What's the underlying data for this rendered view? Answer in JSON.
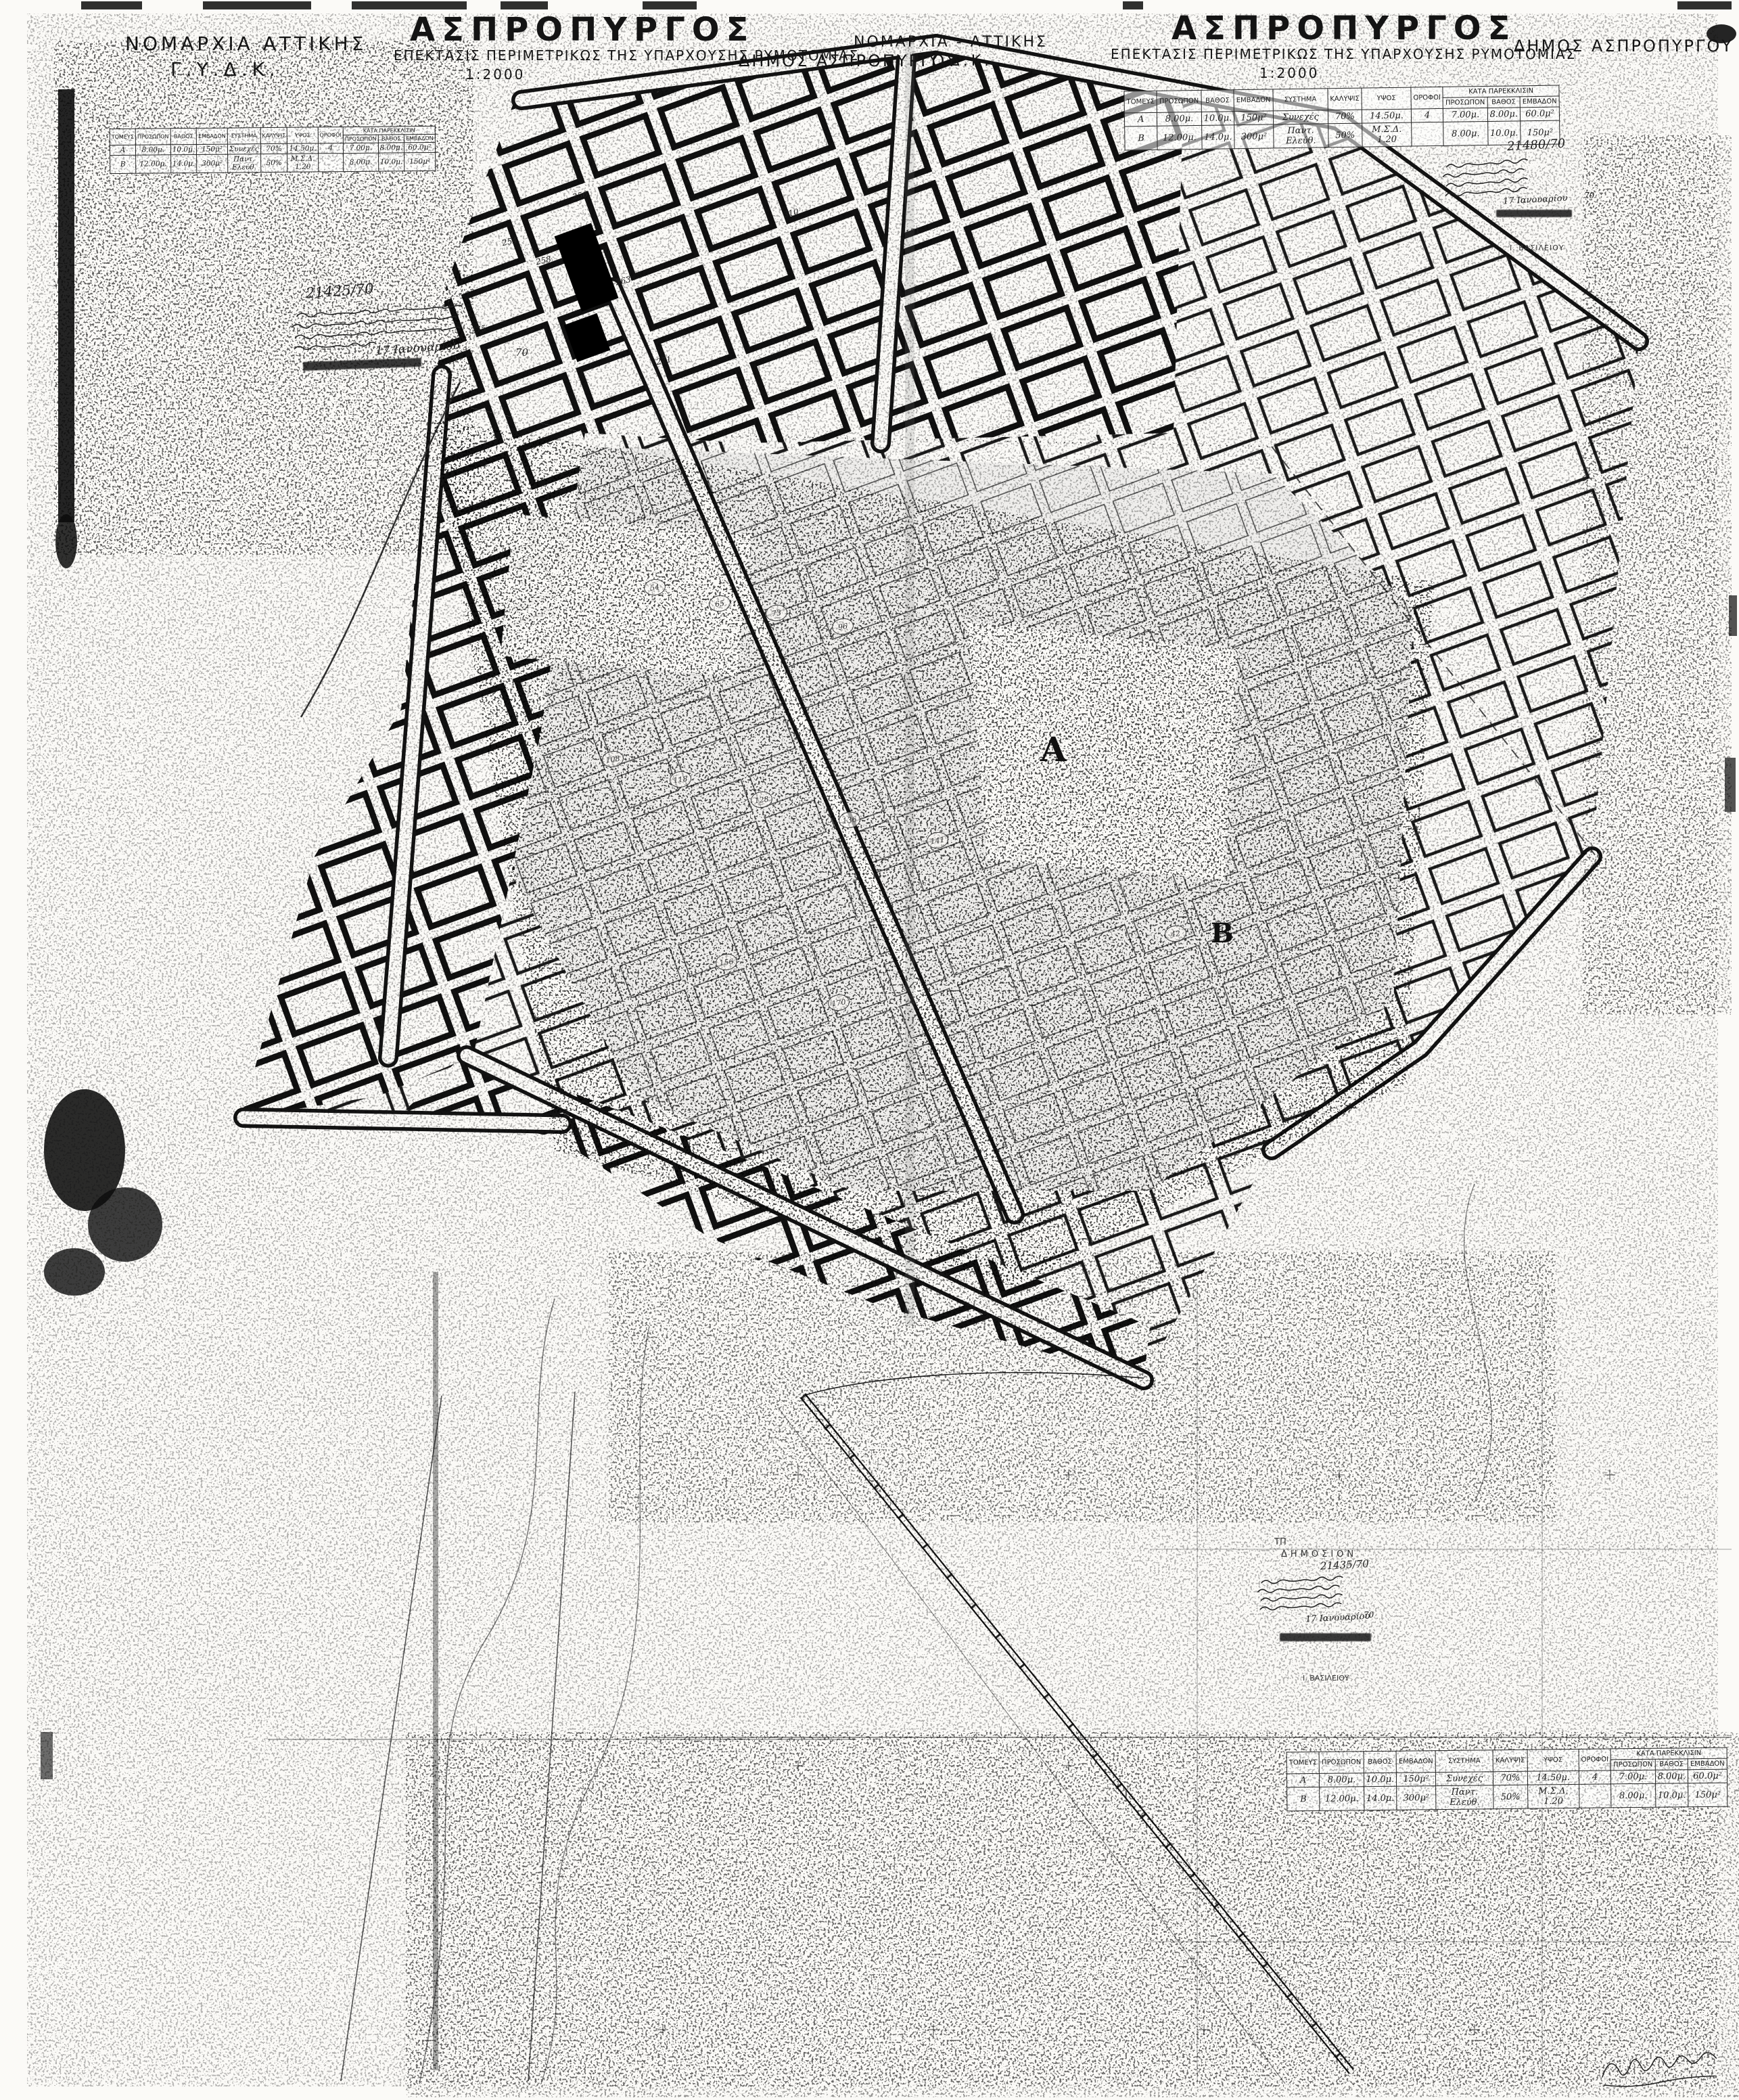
{
  "colors": {
    "paper": "#fbfaf7",
    "ink": "#161616"
  },
  "header": {
    "left_agency": {
      "line1": "ΝΟΜΑΡΧΙΑ ΑΤΤΙΚΗΣ",
      "line2": "Γ.Υ.Δ.Κ."
    },
    "left_title": {
      "city": "ΑΣΠΡΟΠΥΡΓΟΣ",
      "subtitle": "ΕΠΕΚΤΑΣΙΣ ΠΕΡΙΜΕΤΡΙΚΩΣ ΤΗΣ ΥΠΑΡΧΟΥΣΗΣ ΡΥΜΟΤΟΜΙΑΣ",
      "scale": "1:2000"
    },
    "center_municipality": "ΔΗΜΟΣ ΑΣΠΡΟΠΥΡΓΟΥ",
    "center_agency": {
      "line1": "ΝΟΜΑΡΧΙΑ - ΑΤΤΙΚΗΣ",
      "line2": "Γ.Υ.Δ.Κ."
    },
    "right_title": {
      "city": "ΑΣΠΡΟΠΥΡΓΟΣ",
      "subtitle": "ΕΠΕΚΤΑΣΙΣ ΠΕΡΙΜΕΤΡΙΚΩΣ ΤΗΣ ΥΠΑΡΧΟΥΣΗΣ ΡΥΜΟΤΟΜΙΑΣ",
      "scale": "1:2000"
    },
    "right_municipality": "ΔΗΜΟΣ ΑΣΠΡΟΠΥΡΓΟΥ"
  },
  "terms_table": {
    "headers": [
      "ΤΟΜΕΥΣ",
      "ΠΡΟΣΩΠΟΝ",
      "ΒΑΘΟΣ",
      "ΕΜΒΑΔΟΝ",
      "ΣΥΣΤΗΜΑ",
      "ΚΑΛΥΨΙΣ",
      "ΥΨΟΣ",
      "ΟΡΟΦΟΙ"
    ],
    "exception_header": "ΚΑΤΑ ΠΑΡΕΚΚΛΙΣΙΝ",
    "exception_sub": [
      "ΠΡΟΣΩΠΟΝ",
      "ΒΑΘΟΣ",
      "ΕΜΒΑΔΟΝ"
    ],
    "rows": [
      {
        "sector": "Α",
        "frontage": "8.00μ.",
        "depth": "10.0μ.",
        "area": "150μ²",
        "system": "Συνεχές",
        "coverage": "70%",
        "height": "14.50μ.",
        "floors": "4",
        "ex_frontage": "7.00μ.",
        "ex_depth": "8.00μ.",
        "ex_area": "60.0μ²"
      },
      {
        "sector": "Β",
        "frontage": "12.00μ.",
        "depth": "14.0μ.",
        "area": "300μ²",
        "system": "Παντ. Ελεύθ.",
        "coverage": "50%",
        "height": "Μ.Σ.Δ. 1.20",
        "floors": "",
        "ex_frontage": "8.00μ.",
        "ex_depth": "10.0μ.",
        "ex_area": "150μ²"
      }
    ]
  },
  "annotations": {
    "top_left": {
      "number": "21425/70",
      "date": "17 Ιανουαρίου",
      "year": "70"
    },
    "top_right": {
      "number": "21480/70",
      "date": "17 Ιανουαρίου",
      "year": "70",
      "name": "Ι. ΒΑΣΙΛΕΙΟΥ"
    },
    "bottom": {
      "mark": "ΤΠ",
      "label": "ΔΗΜΟΣΙΟΝ",
      "number": "21435/70",
      "date": "17 Ιανουαρίου",
      "year": "70",
      "name": "Ι. ΒΑΣΙΛΕΙΟΥ"
    }
  },
  "map": {
    "sector_a": "Α",
    "sector_b": "Β",
    "block_numbers_dark": [
      "256",
      "258",
      "263",
      "254",
      "275",
      "271",
      "310",
      "151"
    ],
    "block_numbers_circled": [
      "42",
      "54",
      "65",
      "73",
      "96",
      "108",
      "118",
      "128",
      "136",
      "141",
      "156",
      "170"
    ]
  }
}
